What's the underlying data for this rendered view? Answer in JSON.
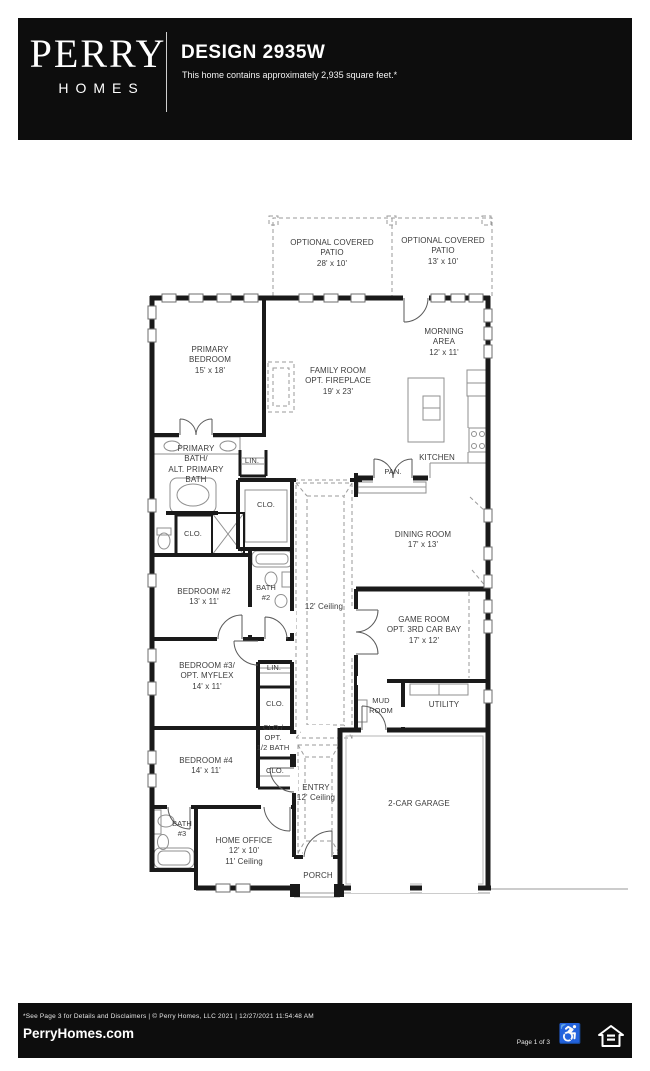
{
  "header": {
    "brand_top": "PERRY",
    "brand_bottom": "HOMES",
    "title": "DESIGN 2935W",
    "subtitle": "This home contains approximately 2,935 square feet.*"
  },
  "floorplan": {
    "rooms": {
      "patio_left": "OPTIONAL COVERED\nPATIO\n28' x 10'",
      "patio_right": "OPTIONAL COVERED\nPATIO\n13' x 10'",
      "primary_bedroom": "PRIMARY\nBEDROOM\n15' x 18'",
      "family_room": "FAMILY ROOM\nOPT. FIREPLACE\n19' x 23'",
      "morning_area": "MORNING\nAREA\n12' x 11'",
      "kitchen": "KITCHEN",
      "pantry": "PAN.",
      "dining_room": "DINING ROOM\n17' x 13'",
      "primary_bath": "PRIMARY\nBATH/\nALT. PRIMARY\nBATH",
      "linen_primary": "LIN.",
      "closet_primary": "CLO.",
      "closet_primary_2": "CLO.",
      "bedroom_2": "BEDROOM #2\n13' x 11'",
      "bath_2": "BATH\n#2",
      "hall_ceiling": "12' Ceiling",
      "game_room": "GAME ROOM\nOPT. 3RD CAR BAY\n17' x 12'",
      "mud_room": "MUD\nROOM",
      "utility": "UTILITY",
      "bedroom_3": "BEDROOM #3/\nOPT. MYFLEX\n14' x 11'",
      "linen_hall": "LIN.",
      "closet_hall": "CLO.",
      "closet_opt_half_bath": "CLO./\nOPT.\n1/2 BATH",
      "bedroom_4": "BEDROOM #4\n14' x 11'",
      "closet_bedroom_4": "CLO.",
      "entry": "ENTRY\n12' Ceiling",
      "bath_3": "BATH\n#3",
      "home_office": "HOME OFFICE\n12' x 10'\n11' Ceiling",
      "porch": "PORCH",
      "garage": "2-CAR GARAGE"
    }
  },
  "footer": {
    "disclaimer": "*See Page 3 for Details and Disclaimers   |   © Perry Homes, LLC 2021   |   12/27/2021 11:54:48 AM",
    "website": "PerryHomes.com",
    "page_indicator": "Page 1 of 3",
    "accessibility_glyph": "♿"
  },
  "colors": {
    "bar_bg": "#0d0d0d",
    "wall": "#1a1a1a",
    "label": "#3c3c3c",
    "detail": "#8f8f8f",
    "dash": "#9a9a9a"
  }
}
